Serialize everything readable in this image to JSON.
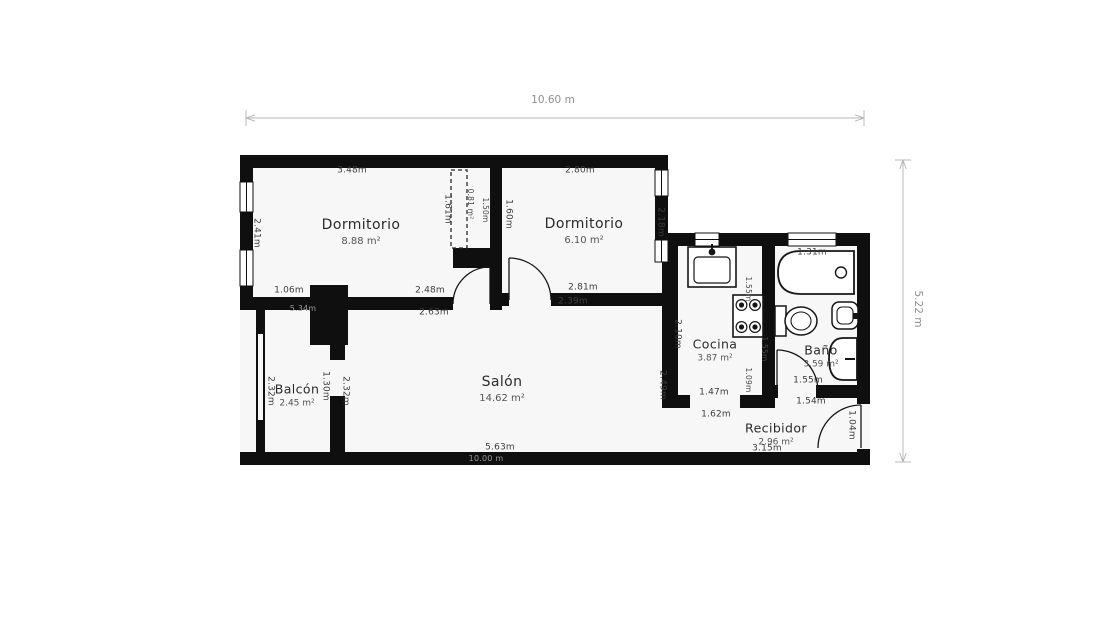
{
  "dimensions": {
    "overall_width": "10.60 m",
    "overall_height": "5.22 m"
  },
  "rooms": {
    "dormitorio1": {
      "name": "Dormitorio",
      "area": "8.88 m²"
    },
    "dormitorio2": {
      "name": "Dormitorio",
      "area": "6.10 m²"
    },
    "salon": {
      "name": "Salón",
      "area": "14.62 m²"
    },
    "cocina": {
      "name": "Cocina",
      "area": "3.87 m²"
    },
    "bano": {
      "name": "Baño",
      "area": "3.59 m²"
    },
    "recibidor": {
      "name": "Recibidor",
      "area": "2.96 m²"
    },
    "balcon": {
      "name": "Balcón",
      "area": "2.45 m²"
    },
    "armario": {
      "area": "0.81 m²"
    }
  },
  "measurements": {
    "dorm1_top": "3.48m",
    "dorm1_left": "2.41m",
    "dorm1_bottom_left": "1.06m",
    "dorm1_bottom_right": "2.48m",
    "dorm1_bottom_outer": "2.63m",
    "armario_left": "1.61m",
    "armario_width": "1.50m",
    "dorm2_left": "1.60m",
    "dorm2_top": "2.80m",
    "dorm2_right": "2.18m",
    "dorm2_bottom": "2.81m",
    "dorm2_bottom_outer": "2.39m",
    "balcon_left": "2.32m",
    "balcon_door": "1.30m",
    "salon_left": "2.32m",
    "salon_hidden_top": "5.34m",
    "salon_bottom": "5.63m",
    "salon_hidden_bottom": "10.00 m",
    "salon_right_upper": "2.10m",
    "salon_right_lower": "2.49m",
    "cocina_counter": "1.55m",
    "cocina_right_wall": "1.55m",
    "cocina_right_lower": "1.09m",
    "cocina_bottom": "1.47m",
    "cocina_bottom_outer": "1.62m",
    "bano_window": "1.31m",
    "bano_bottom": "1.55m",
    "recibidor_top": "1.54m",
    "recibidor_bottom": "3.15m",
    "entrance_door": "1.04m"
  },
  "colors": {
    "wall": "#0f0f0f",
    "floor": "#f7f7f7",
    "dimension_line": "#b8b8b8"
  }
}
